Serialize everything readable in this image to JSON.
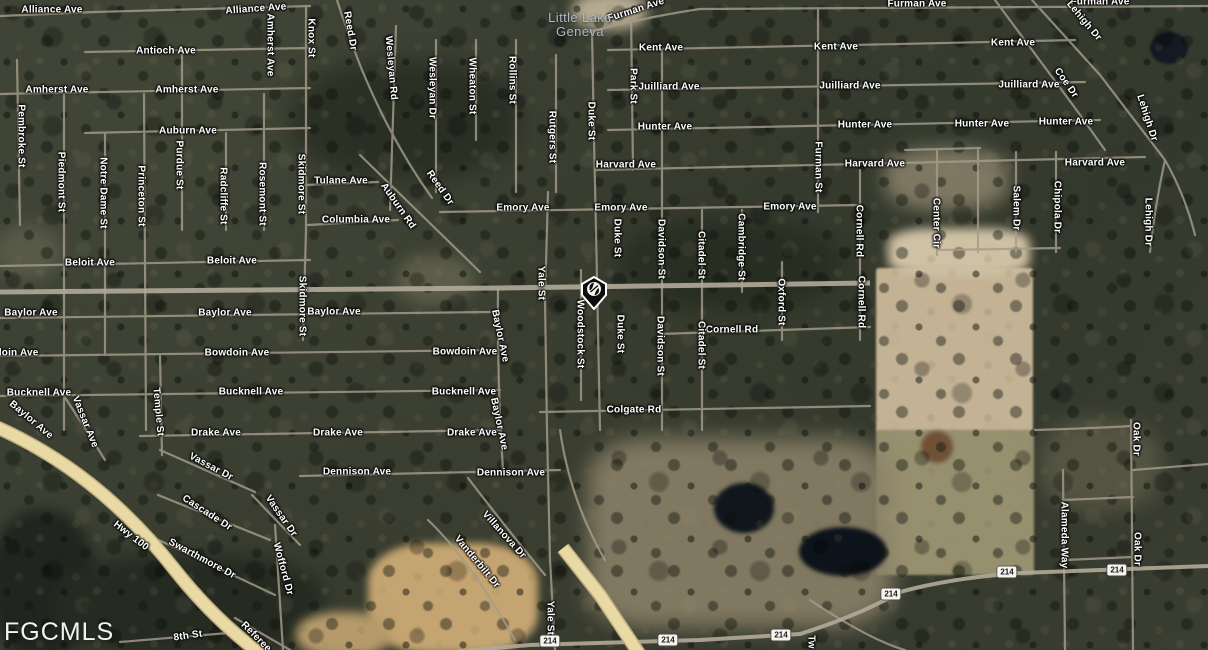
{
  "watermark": "FGCMLS",
  "place_label": {
    "line1": "Little Lake",
    "line2": "Geneva",
    "color": "#a9bac8"
  },
  "marker": {
    "description": "black shield location pin with white emblem",
    "fill": "#0d0d0d",
    "outline": "#ffffff"
  },
  "route_shield_text": "214",
  "route_shields": [
    {
      "x": 550,
      "y": 641
    },
    {
      "x": 668,
      "y": 640
    },
    {
      "x": 781,
      "y": 635
    },
    {
      "x": 891,
      "y": 594
    },
    {
      "x": 1007,
      "y": 572
    },
    {
      "x": 1117,
      "y": 570
    }
  ],
  "colors": {
    "highway_yellow": "#e9d9a4",
    "road": "#a59c8b",
    "label_text": "#ffffff",
    "terrain_dark": "#383d30",
    "field_tan": "#c3b294",
    "field_green": "#96906f",
    "pond": "#10161c"
  },
  "street_labels": [
    {
      "t": "Alliance Ave",
      "x": 52,
      "y": 10,
      "r": 0
    },
    {
      "t": "Alliance Ave",
      "x": 256,
      "y": 9,
      "r": -4
    },
    {
      "t": "Antioch Ave",
      "x": 166,
      "y": 51,
      "r": 0
    },
    {
      "t": "Amherst Ave",
      "x": 57,
      "y": 90,
      "r": 0
    },
    {
      "t": "Amherst Ave",
      "x": 187,
      "y": 90,
      "r": 0
    },
    {
      "t": "Amherst Ave",
      "x": 270,
      "y": 45,
      "r": 90
    },
    {
      "t": "Knox St",
      "x": 311,
      "y": 38,
      "r": 90
    },
    {
      "t": "Auburn Ave",
      "x": 188,
      "y": 131,
      "r": 0
    },
    {
      "t": "Pembroke St",
      "x": 21,
      "y": 136,
      "r": 90
    },
    {
      "t": "Piedmont St",
      "x": 61,
      "y": 182,
      "r": 90
    },
    {
      "t": "Notre Dame St",
      "x": 103,
      "y": 193,
      "r": 90
    },
    {
      "t": "Princeton St",
      "x": 141,
      "y": 196,
      "r": 90
    },
    {
      "t": "Purdue St",
      "x": 179,
      "y": 165,
      "r": 90
    },
    {
      "t": "Radcliffe St",
      "x": 223,
      "y": 196,
      "r": 90
    },
    {
      "t": "Rosemont St",
      "x": 262,
      "y": 194,
      "r": 90
    },
    {
      "t": "Skidmore St",
      "x": 301,
      "y": 184,
      "r": 90
    },
    {
      "t": "Skidmore St",
      "x": 302,
      "y": 306,
      "r": 90
    },
    {
      "t": "Reed Dr",
      "x": 350,
      "y": 31,
      "r": 80
    },
    {
      "t": "Wesleyan Rd",
      "x": 391,
      "y": 68,
      "r": 85
    },
    {
      "t": "Wesleyan Dr",
      "x": 432,
      "y": 88,
      "r": 90
    },
    {
      "t": "Wheaton St",
      "x": 472,
      "y": 86,
      "r": 90
    },
    {
      "t": "Rollins St",
      "x": 512,
      "y": 80,
      "r": 90
    },
    {
      "t": "Rutgers St",
      "x": 552,
      "y": 137,
      "r": 90
    },
    {
      "t": "Duke St",
      "x": 591,
      "y": 121,
      "r": 90
    },
    {
      "t": "Duke St",
      "x": 617,
      "y": 238,
      "r": 90
    },
    {
      "t": "Duke St",
      "x": 620,
      "y": 334,
      "r": 90
    },
    {
      "t": "Tulane Ave",
      "x": 341,
      "y": 181,
      "r": 0
    },
    {
      "t": "Auburn Rd",
      "x": 398,
      "y": 206,
      "r": 55
    },
    {
      "t": "Reed Dr",
      "x": 440,
      "y": 188,
      "r": 55
    },
    {
      "t": "Columbia Ave",
      "x": 356,
      "y": 220,
      "r": 0
    },
    {
      "t": "Furman Ave",
      "x": 636,
      "y": 10,
      "r": -18
    },
    {
      "t": "Furman Ave",
      "x": 917,
      "y": 4,
      "r": 0
    },
    {
      "t": "Furman Ave",
      "x": 1100,
      "y": 2,
      "r": 0
    },
    {
      "t": "Kent Ave",
      "x": 661,
      "y": 48,
      "r": 0
    },
    {
      "t": "Kent Ave",
      "x": 836,
      "y": 47,
      "r": 0
    },
    {
      "t": "Kent Ave",
      "x": 1013,
      "y": 43,
      "r": 0
    },
    {
      "t": "Park St",
      "x": 633,
      "y": 86,
      "r": 90
    },
    {
      "t": "Juilliard Ave",
      "x": 669,
      "y": 87,
      "r": 0
    },
    {
      "t": "Juilliard Ave",
      "x": 850,
      "y": 86,
      "r": 0
    },
    {
      "t": "Juilliard Ave",
      "x": 1029,
      "y": 85,
      "r": 0
    },
    {
      "t": "Hunter Ave",
      "x": 665,
      "y": 127,
      "r": 0
    },
    {
      "t": "Hunter Ave",
      "x": 865,
      "y": 125,
      "r": 0
    },
    {
      "t": "Hunter Ave",
      "x": 982,
      "y": 124,
      "r": 0
    },
    {
      "t": "Hunter Ave",
      "x": 1066,
      "y": 122,
      "r": 0
    },
    {
      "t": "Furman St",
      "x": 818,
      "y": 167,
      "r": 90
    },
    {
      "t": "Harvard Ave",
      "x": 626,
      "y": 165,
      "r": 0
    },
    {
      "t": "Harvard Ave",
      "x": 875,
      "y": 164,
      "r": 0
    },
    {
      "t": "Harvard Ave",
      "x": 1095,
      "y": 163,
      "r": 0
    },
    {
      "t": "Emory Ave",
      "x": 523,
      "y": 208,
      "r": 0
    },
    {
      "t": "Emory Ave",
      "x": 621,
      "y": 208,
      "r": 0
    },
    {
      "t": "Emory Ave",
      "x": 790,
      "y": 207,
      "r": 0
    },
    {
      "t": "Lehigh Dr",
      "x": 1084,
      "y": 21,
      "r": 50
    },
    {
      "t": "Lehigh Dr",
      "x": 1147,
      "y": 118,
      "r": 72
    },
    {
      "t": "Lehigh Dr",
      "x": 1148,
      "y": 222,
      "r": 90
    },
    {
      "t": "Coe Dr",
      "x": 1066,
      "y": 83,
      "r": 55
    },
    {
      "t": "Salem Dr",
      "x": 1016,
      "y": 208,
      "r": 90
    },
    {
      "t": "Chipola Dr",
      "x": 1057,
      "y": 207,
      "r": 90
    },
    {
      "t": "Center Cir",
      "x": 936,
      "y": 223,
      "r": 90
    },
    {
      "t": "Cornell Rd",
      "x": 859,
      "y": 231,
      "r": 90
    },
    {
      "t": "Cornell Rd",
      "x": 861,
      "y": 302,
      "r": 90
    },
    {
      "t": "Cornell Rd",
      "x": 732,
      "y": 330,
      "r": 0
    },
    {
      "t": "Beloit Ave",
      "x": 90,
      "y": 263,
      "r": 0
    },
    {
      "t": "Beloit Ave",
      "x": 232,
      "y": 261,
      "r": 0
    },
    {
      "t": "Baylor Ave",
      "x": 31,
      "y": 313,
      "r": 0
    },
    {
      "t": "Baylor Ave",
      "x": 225,
      "y": 313,
      "r": 0
    },
    {
      "t": "Baylor Ave",
      "x": 334,
      "y": 312,
      "r": 0
    },
    {
      "t": "doin Ave",
      "x": 17,
      "y": 353,
      "r": 0
    },
    {
      "t": "Bowdoin Ave",
      "x": 237,
      "y": 353,
      "r": 0
    },
    {
      "t": "Bowdoin Ave",
      "x": 465,
      "y": 352,
      "r": 0
    },
    {
      "t": "Bucknell Ave",
      "x": 39,
      "y": 393,
      "r": 0
    },
    {
      "t": "Bucknell Ave",
      "x": 251,
      "y": 392,
      "r": 0
    },
    {
      "t": "Bucknell Ave",
      "x": 464,
      "y": 392,
      "r": 0
    },
    {
      "t": "Yale St",
      "x": 541,
      "y": 283,
      "r": 90
    },
    {
      "t": "Yale St",
      "x": 550,
      "y": 618,
      "r": 90
    },
    {
      "t": "Woodstock St",
      "x": 580,
      "y": 334,
      "r": 90
    },
    {
      "t": "Baylor Ave",
      "x": 500,
      "y": 336,
      "r": 78
    },
    {
      "t": "Baylor Ave",
      "x": 499,
      "y": 424,
      "r": 78
    },
    {
      "t": "Davidson St",
      "x": 661,
      "y": 249,
      "r": 90
    },
    {
      "t": "Davidson St",
      "x": 660,
      "y": 346,
      "r": 90
    },
    {
      "t": "Citadel St",
      "x": 701,
      "y": 255,
      "r": 90
    },
    {
      "t": "Citadel St",
      "x": 701,
      "y": 345,
      "r": 90
    },
    {
      "t": "Cambridge St",
      "x": 741,
      "y": 247,
      "r": 90
    },
    {
      "t": "Oxford St",
      "x": 781,
      "y": 302,
      "r": 90
    },
    {
      "t": "Colgate Rd",
      "x": 634,
      "y": 410,
      "r": 0
    },
    {
      "t": "Baylor Ave",
      "x": 31,
      "y": 420,
      "r": 40
    },
    {
      "t": "Vassar Ave",
      "x": 85,
      "y": 422,
      "r": 68
    },
    {
      "t": "Temple St",
      "x": 158,
      "y": 412,
      "r": 85
    },
    {
      "t": "Drake Ave",
      "x": 216,
      "y": 433,
      "r": 0
    },
    {
      "t": "Drake Ave",
      "x": 338,
      "y": 433,
      "r": 0
    },
    {
      "t": "Drake Ave",
      "x": 472,
      "y": 433,
      "r": 0
    },
    {
      "t": "Vassar Dr",
      "x": 211,
      "y": 467,
      "r": 28
    },
    {
      "t": "Cascade Dr",
      "x": 207,
      "y": 513,
      "r": 33
    },
    {
      "t": "Vassar Dr",
      "x": 281,
      "y": 516,
      "r": 55
    },
    {
      "t": "Swarthmore Dr",
      "x": 202,
      "y": 559,
      "r": 28
    },
    {
      "t": "Wofford Dr",
      "x": 283,
      "y": 569,
      "r": 75
    },
    {
      "t": "Dennison Ave",
      "x": 357,
      "y": 472,
      "r": 0
    },
    {
      "t": "Dennison Ave",
      "x": 511,
      "y": 473,
      "r": 0
    },
    {
      "t": "Villanova Dr",
      "x": 504,
      "y": 535,
      "r": 48
    },
    {
      "t": "Vanderbilt Dr",
      "x": 477,
      "y": 562,
      "r": 50
    },
    {
      "t": "Hwy 100",
      "x": 131,
      "y": 536,
      "r": 38
    },
    {
      "t": "8th St",
      "x": 188,
      "y": 636,
      "r": -8
    },
    {
      "t": "Referee",
      "x": 256,
      "y": 637,
      "r": 45
    },
    {
      "t": "Tw",
      "x": 811,
      "y": 642,
      "r": 90
    },
    {
      "t": "Oak Dr",
      "x": 1136,
      "y": 439,
      "r": 90
    },
    {
      "t": "Oak Dr",
      "x": 1137,
      "y": 549,
      "r": 90
    },
    {
      "t": "Alameda Way",
      "x": 1064,
      "y": 535,
      "r": 90
    }
  ]
}
